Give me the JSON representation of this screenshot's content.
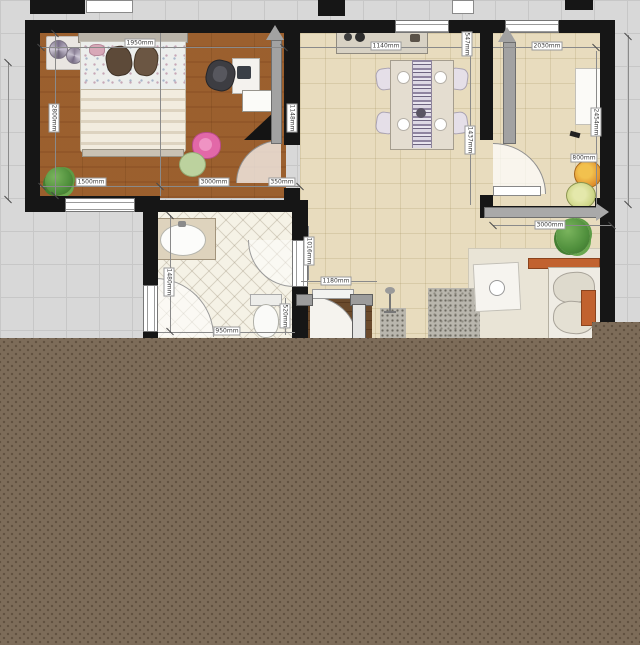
{
  "app": {
    "view": "floor-plan-canvas",
    "note": "2D top-down floor plan render, lower portion covered by solid brown region"
  },
  "canvas": {
    "background": "#d8d8d8",
    "grid_line": "#c7c7c7",
    "grid_size_px": 33
  },
  "covered_region": {
    "color": "#7d6c59",
    "dot_color": "rgba(62,48,33,0.45)"
  },
  "palette": {
    "wall": "#161616",
    "bedroom_wood_floor": "#c59a6b",
    "tile_floor": "#e8dcbe",
    "bathroom_floor": "#f5f2e6",
    "entry_dark_wood": "#6a4a2c",
    "dimension_line": "#8a8a8a",
    "accent_orange": "#c1622f",
    "plant_green": "#4f8f3c",
    "pink_chair": "#e06aaa"
  },
  "rooms": [
    {
      "name": "bedroom"
    },
    {
      "name": "dining-room"
    },
    {
      "name": "kitchen"
    },
    {
      "name": "bathroom"
    },
    {
      "name": "entry-hall"
    },
    {
      "name": "living-area"
    }
  ],
  "dimension_labels": [
    {
      "text": "1950mm",
      "x": 140,
      "y": 43,
      "vertical": false
    },
    {
      "text": "2800mm",
      "x": 54,
      "y": 118,
      "vertical": true
    },
    {
      "text": "1500mm",
      "x": 91,
      "y": 182,
      "vertical": false
    },
    {
      "text": "3000mm",
      "x": 214,
      "y": 182,
      "vertical": false
    },
    {
      "text": "350mm",
      "x": 282,
      "y": 182,
      "vertical": false
    },
    {
      "text": "1148mm",
      "x": 292,
      "y": 118,
      "vertical": true
    },
    {
      "text": "1140mm",
      "x": 386,
      "y": 46,
      "vertical": false
    },
    {
      "text": "547mm",
      "x": 467,
      "y": 44,
      "vertical": true
    },
    {
      "text": "1437mm",
      "x": 470,
      "y": 140,
      "vertical": true
    },
    {
      "text": "2030mm",
      "x": 547,
      "y": 46,
      "vertical": false
    },
    {
      "text": "2454mm",
      "x": 596,
      "y": 122,
      "vertical": true
    },
    {
      "text": "800mm",
      "x": 584,
      "y": 158,
      "vertical": false
    },
    {
      "text": "3000mm",
      "x": 550,
      "y": 225,
      "vertical": false
    },
    {
      "text": "1480mm",
      "x": 169,
      "y": 282,
      "vertical": true
    },
    {
      "text": "950mm",
      "x": 227,
      "y": 331,
      "vertical": false
    },
    {
      "text": "520mm",
      "x": 285,
      "y": 316,
      "vertical": true
    },
    {
      "text": "1016mm",
      "x": 309,
      "y": 251,
      "vertical": true
    },
    {
      "text": "1180mm",
      "x": 336,
      "y": 281,
      "vertical": false
    }
  ]
}
